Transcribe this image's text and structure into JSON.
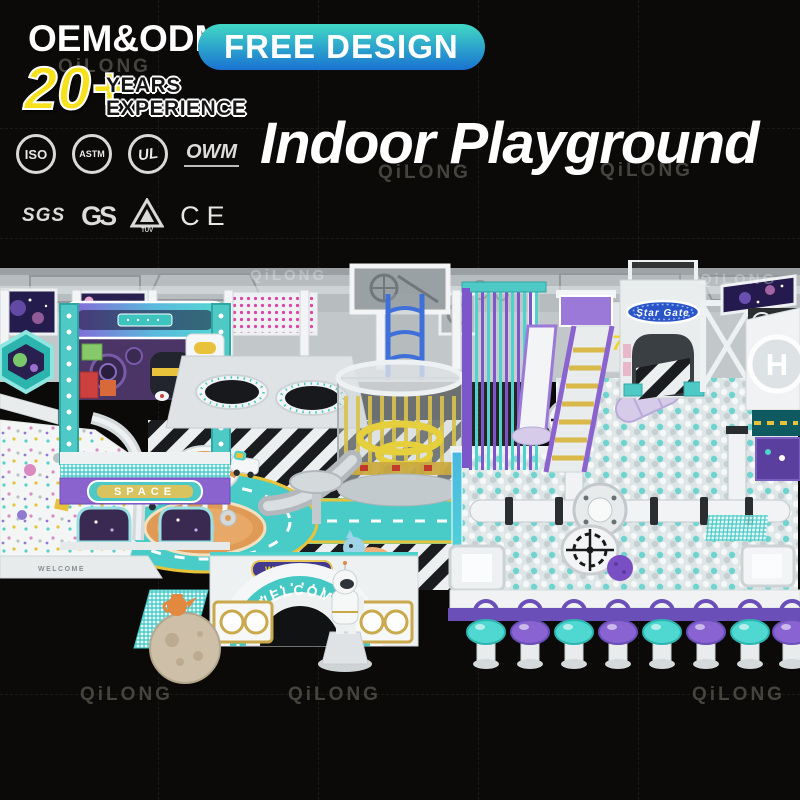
{
  "brand": {
    "watermark": "QiLONG"
  },
  "header": {
    "oem_odm": "OEM&ODM",
    "free_design": "FREE DESIGN",
    "years_number": "20+",
    "years_line1": "YEARS",
    "years_line2": "EXPERIENCE",
    "title": "Indoor Playground"
  },
  "certifications": {
    "row1": [
      {
        "id": "iso",
        "label": "ISO"
      },
      {
        "id": "astm",
        "label": "ASTM"
      },
      {
        "id": "ul",
        "label": "UL"
      },
      {
        "id": "owm",
        "label": "OWM"
      }
    ],
    "row2": [
      {
        "id": "sgs",
        "label": "SGS"
      },
      {
        "id": "gs",
        "label": "GS"
      },
      {
        "id": "tuv",
        "label": "TÜV"
      },
      {
        "id": "ce",
        "label": "CE"
      }
    ]
  },
  "playground": {
    "signs": {
      "space": "SPACE",
      "welcome_arch": "WELCOME",
      "welcome_small": "WELCOME",
      "star_gate": "Star Gate",
      "gate_number": "07",
      "helipad": "H",
      "wall_rim": "WELCOME"
    },
    "colors": {
      "teal": "#4fd2cc",
      "purple": "#7b57c9",
      "yellow": "#f6e11b",
      "orange": "#e2974f",
      "ballpit_teal": "#6fd4d0",
      "wall_gray": "#c2c7ca"
    }
  }
}
